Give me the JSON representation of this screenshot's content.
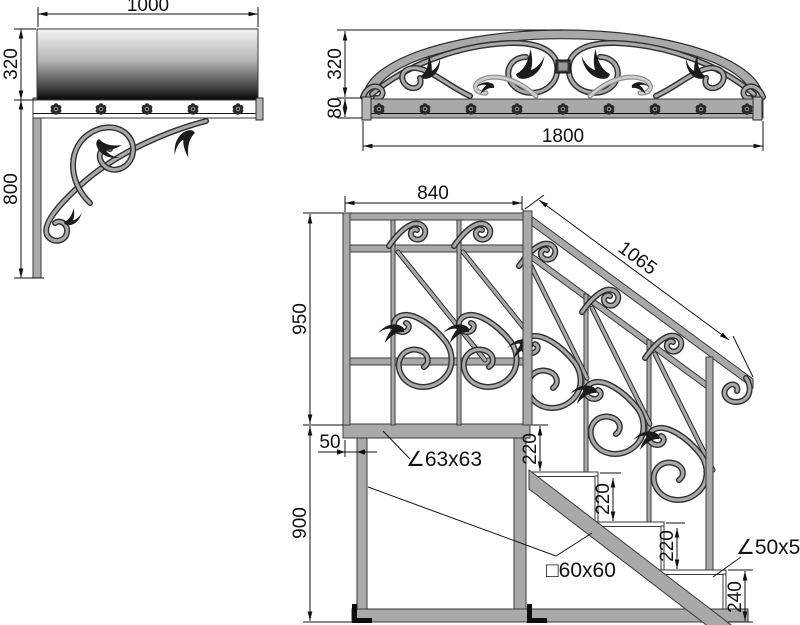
{
  "dims": {
    "canopy_side": {
      "width": "1000",
      "height": "320",
      "bracket_height": "800"
    },
    "canopy_front": {
      "arch_height": "320",
      "band_height": "80",
      "width": "1800"
    },
    "stairs": {
      "panel_width": "840",
      "handrail_length": "1065",
      "railing_height": "950",
      "base_height": "900",
      "leg_offset": "50",
      "step_rises": [
        "220",
        "220",
        "220"
      ],
      "bottom_step_height": "240",
      "platform_profile": "∠63x63",
      "frame_profile": "□60x60",
      "step_profile": "∠50x50"
    }
  },
  "colors": {
    "metal": "#a9a9a9",
    "outline": "#2f2f2f",
    "dimension": "#111111"
  }
}
